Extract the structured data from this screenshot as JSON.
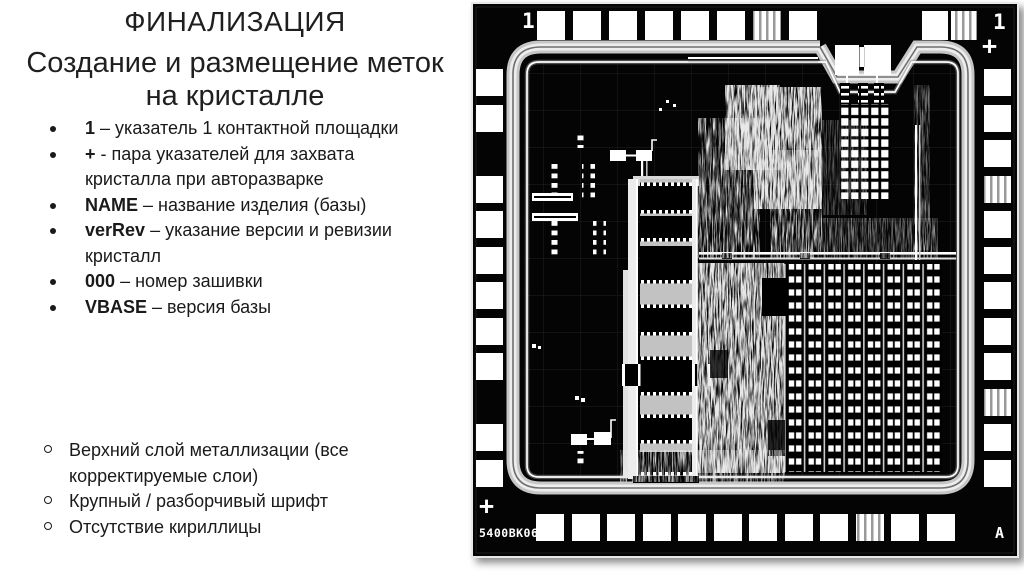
{
  "slide": {
    "title": "ФИНАЛИЗАЦИЯ",
    "subtitle_line1": "Создание и размещение меток",
    "subtitle_line2": "на кристалле",
    "bullets": [
      {
        "term": "1",
        "rest": "– указатель 1 контактной площадки"
      },
      {
        "term": "+",
        "rest": "- пара указателей для захвата кристалла при авторазварке"
      },
      {
        "term": "NAME",
        "rest": "– название изделия (базы)"
      },
      {
        "term": "verRev",
        "rest": "– указание версии и ревизии кристалл"
      },
      {
        "term": "000",
        "rest": "– номер зашивки"
      },
      {
        "term": "VBASE",
        "rest": "– версия базы"
      }
    ],
    "sub_bullets": [
      "Верхний слой металлизации (все корректируемые слои)",
      "Крупный / разборчивый шрифт",
      "Отсутствие кириллицы"
    ]
  },
  "die": {
    "mark_top_left": "1",
    "mark_top_right_one": "1",
    "mark_top_right_plus": "+",
    "mark_bottom_left_plus": "+",
    "part_number": "5400BK06",
    "mark_bottom_right": "A",
    "colors": {
      "die_background": "#000000",
      "bond_pad": "#ffffff",
      "seal_ring": "#c6c6c6"
    }
  }
}
